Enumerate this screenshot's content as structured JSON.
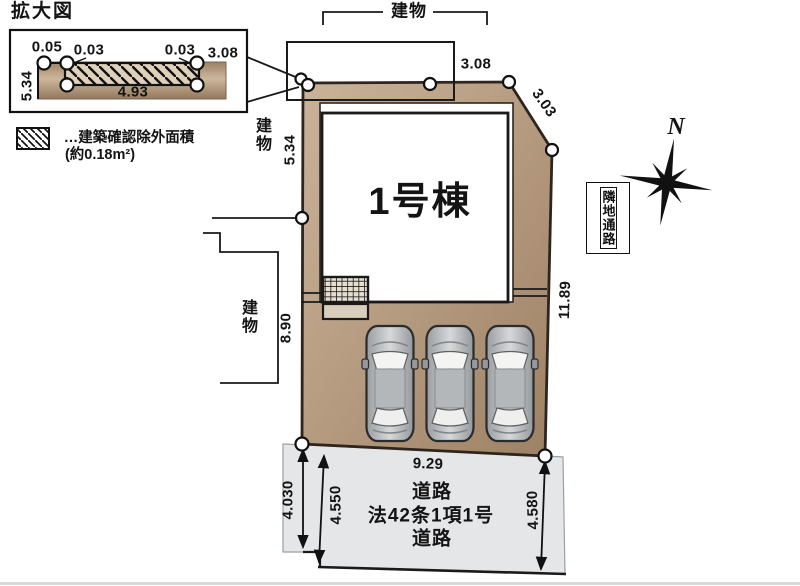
{
  "inset": {
    "title": "拡大図",
    "dim_005": "0.05",
    "dim_003a": "0.03",
    "dim_003b": "0.03",
    "dim_308": "3.08",
    "dim_534": "5.34",
    "dim_493": "4.93",
    "legend_label": "…建築確認除外面積",
    "legend_area": "(約0.18m²)"
  },
  "plan": {
    "building_name": "1号棟",
    "neighbor_top": "建物",
    "neighbor_upper_left": "建物",
    "neighbor_lower_left": "建物",
    "dim_top": "3.08",
    "dim_diag": "3.03",
    "dim_left_upper": "5.34",
    "dim_left_lower": "8.90",
    "dim_right": "11.89",
    "dim_bottom": "9.29",
    "side_label": "隣地通路"
  },
  "road": {
    "label_line1": "道路",
    "label_line2": "法42条1項1号",
    "label_line3": "道路",
    "dim_left": "4.030",
    "dim_mid": "4.550",
    "dim_right": "4.580"
  },
  "compass": {
    "label": "N"
  },
  "colors": {
    "lot_fill": "#b49a80",
    "road_fill": "#e4e6e8",
    "line": "#141414"
  }
}
